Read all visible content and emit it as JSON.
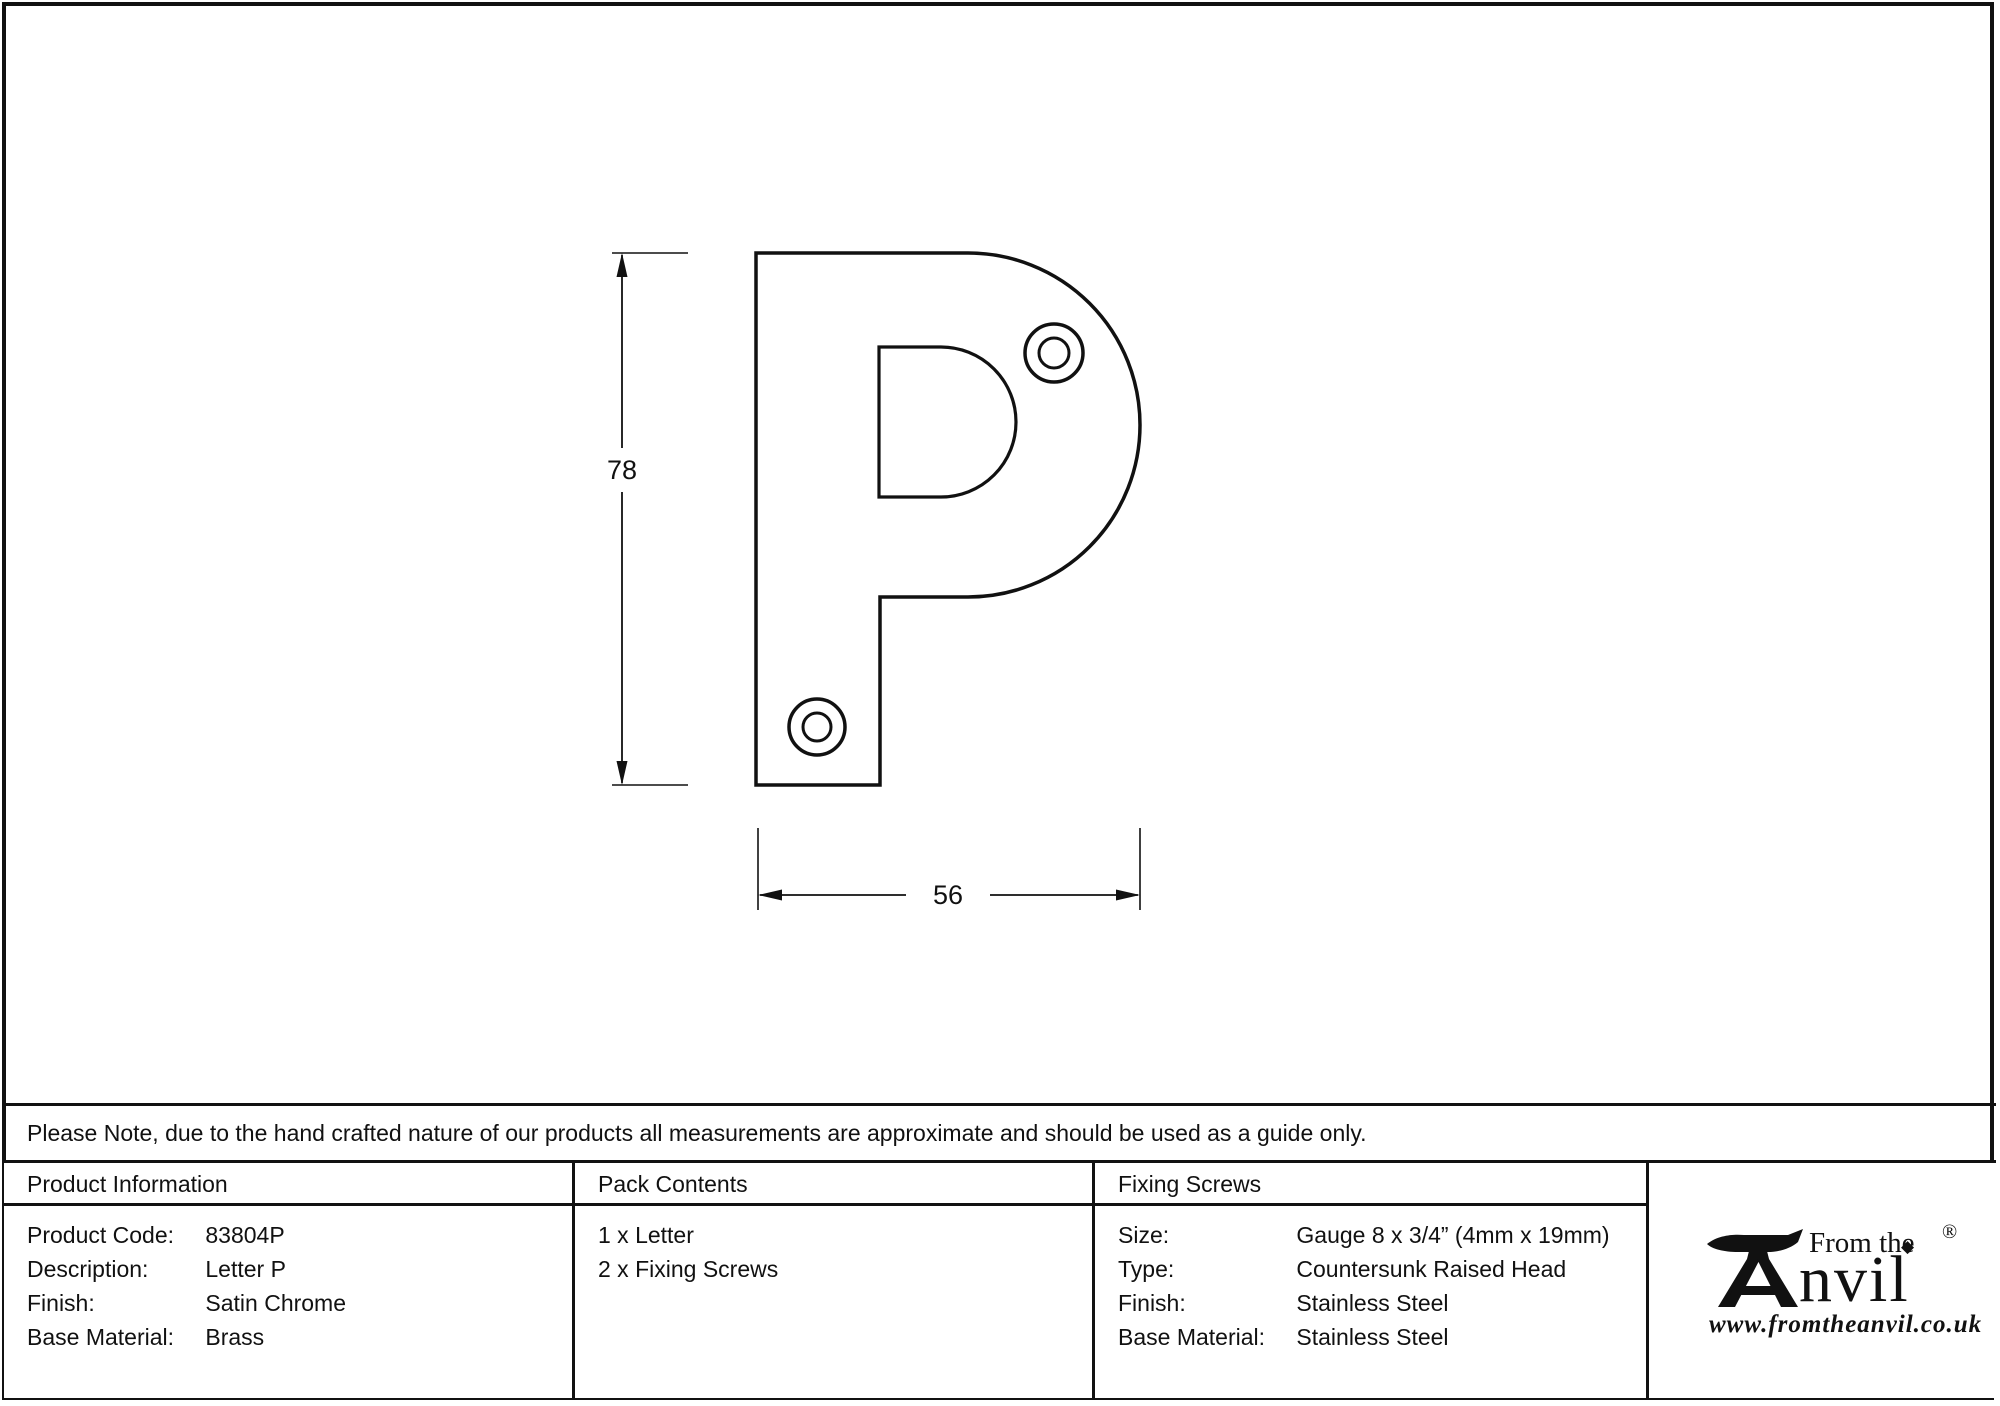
{
  "page": {
    "note": "Please Note, due to the hand crafted nature of our products all measurements are approximate and should be used as a guide only."
  },
  "drawing": {
    "letter": "P",
    "height_label": "78",
    "width_label": "56"
  },
  "product_information": {
    "header": "Product Information",
    "rows": [
      {
        "label": "Product Code:",
        "value": "83804P"
      },
      {
        "label": "Description:",
        "value": "Letter P"
      },
      {
        "label": "Finish:",
        "value": "Satin Chrome"
      },
      {
        "label": "Base Material:",
        "value": "Brass"
      }
    ]
  },
  "pack_contents": {
    "header": "Pack Contents",
    "items": [
      "1 x Letter",
      "2 x Fixing Screws"
    ]
  },
  "fixing_screws": {
    "header": "Fixing Screws",
    "rows": [
      {
        "label": "Size:",
        "value": "Gauge 8 x 3/4” (4mm x 19mm)"
      },
      {
        "label": "Type:",
        "value": "Countersunk Raised Head"
      },
      {
        "label": "Finish:",
        "value": "Stainless Steel"
      },
      {
        "label": "Base Material:",
        "value": "Stainless Steel"
      }
    ]
  },
  "logo": {
    "tagline": "From the",
    "brand": "Anvil",
    "brand_suffix": "nvil",
    "registered_mark": "®",
    "diamond_glyph": "◆",
    "website": "www.fromtheanvil.co.uk"
  },
  "colors": {
    "line": "#111111",
    "background": "#ffffff"
  }
}
